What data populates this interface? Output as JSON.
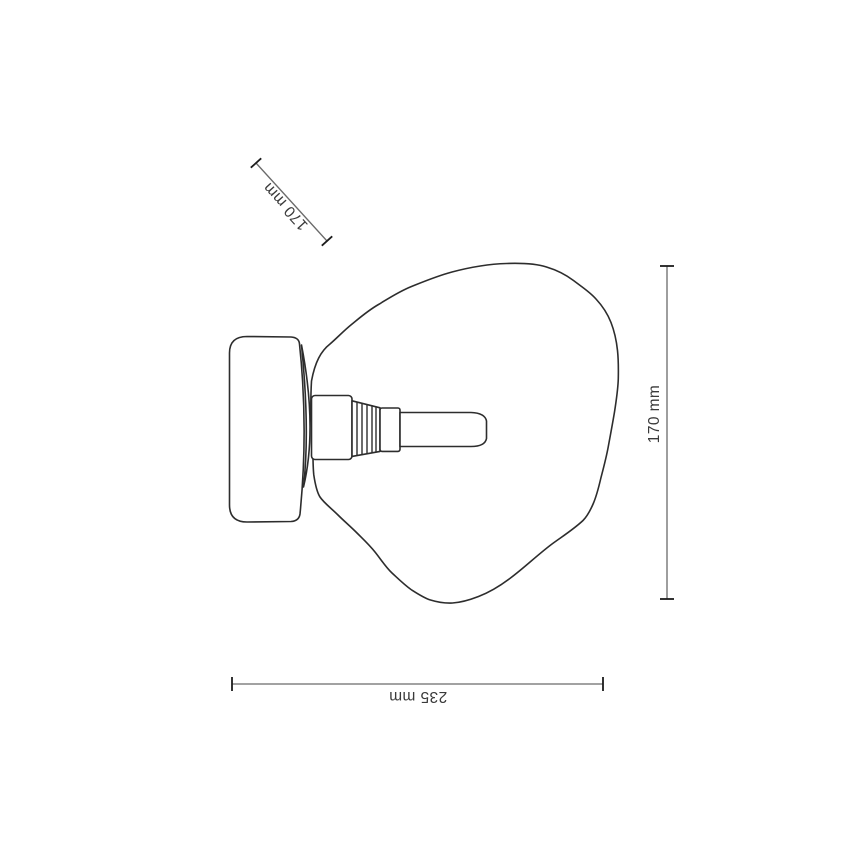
{
  "page": {
    "title": "Wall light dimension diagram",
    "background_color": "#ffffff"
  },
  "drawing": {
    "subject": "wall-mounted lamp with organic blob glass shade, side view line drawing",
    "parts": {
      "canopy": "wall mount canopy cylinder",
      "joint": "canopy-to-glass joint ring",
      "socket_body": "lamp socket body",
      "socket_threads": "threaded socket section",
      "socket_collar": "socket collar",
      "bulb_tube": "tubular bulb stem",
      "shade": "organic glass shade outline"
    },
    "colors": {
      "outline": "#2d2d2d",
      "dimension_line": "#6a6a6a",
      "dimension_tick": "#1c1c1c",
      "label_text": "#3a3a3a"
    }
  },
  "dimensions": [
    {
      "id": "depth-diagonal",
      "label": "170 mm",
      "orientation": "diagonal",
      "position": "top-left",
      "text_flipped": true
    },
    {
      "id": "height-vertical",
      "label": "170 mm",
      "orientation": "vertical",
      "position": "right",
      "text_flipped": false
    },
    {
      "id": "width-horizontal",
      "label": "235 mm",
      "orientation": "horizontal",
      "position": "bottom",
      "text_flipped": true
    }
  ]
}
